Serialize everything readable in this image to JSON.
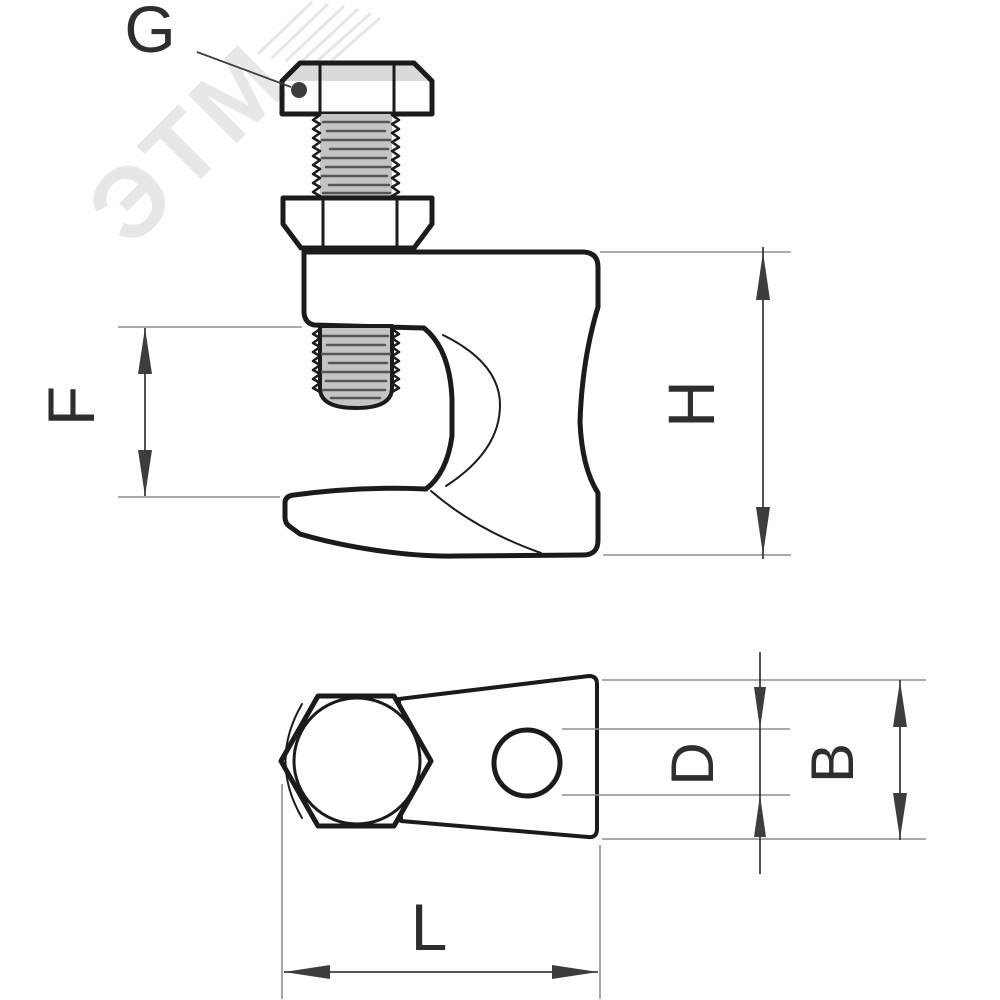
{
  "drawing": {
    "kind": "technical dimensional drawing",
    "subject": "beam flange clamp with hex head screw — side elevation and bottom view",
    "watermark": "ЭТМ",
    "labels": {
      "g": "G",
      "f": "F",
      "h": "H",
      "d": "D",
      "b": "B",
      "l": "L"
    },
    "colors": {
      "line": "#1b1b1b",
      "dimension": "#3d3d3d",
      "extension": "#8f8f8f",
      "label": "#2e2e2e",
      "watermark": "#e7e7e7",
      "thread_fill": "#c4c4c4",
      "thread_streak": "#565656",
      "chamfer_fill": "#dadada",
      "background": "#fefefe"
    }
  }
}
